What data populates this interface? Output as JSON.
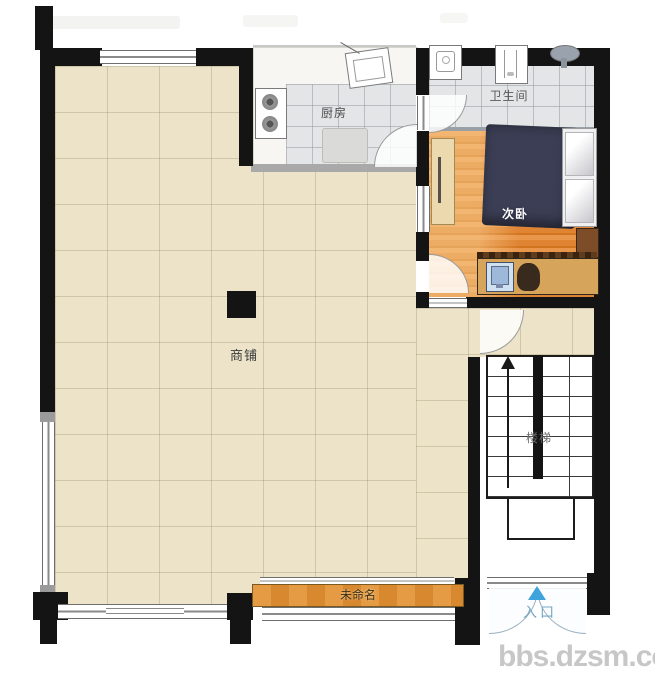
{
  "watermark": "bbs.dzsm.com",
  "rooms": {
    "shop": {
      "label": "商铺"
    },
    "kitchen": {
      "label": "厨房"
    },
    "bathroom": {
      "label": "卫生间"
    },
    "bedroom": {
      "label": "次卧"
    },
    "stairs": {
      "label": "楼梯"
    },
    "unnamed": {
      "label": "未命名"
    },
    "entrance": {
      "label": "入口"
    }
  },
  "icons": [
    "stove-icon",
    "kitchen-sink-icon",
    "toilet-icon",
    "washbasin-icon",
    "shower-icon",
    "bed",
    "wardrobe",
    "desk",
    "computer-icon",
    "chair",
    "nightstand",
    "stairs-up-arrow-icon",
    "entrance-arrow-icon",
    "door-arc",
    "column"
  ],
  "colors": {
    "wall": "#141414",
    "shop_floor": "#ece3c9",
    "tile_floor": "#e3e5e7",
    "wood_floor": "#e08a38",
    "bed": "#3b3e54",
    "accent_blue": "#3fa3dc",
    "entrance_text": "#74a7c4",
    "watermark_gray": "#c7c7c7"
  }
}
